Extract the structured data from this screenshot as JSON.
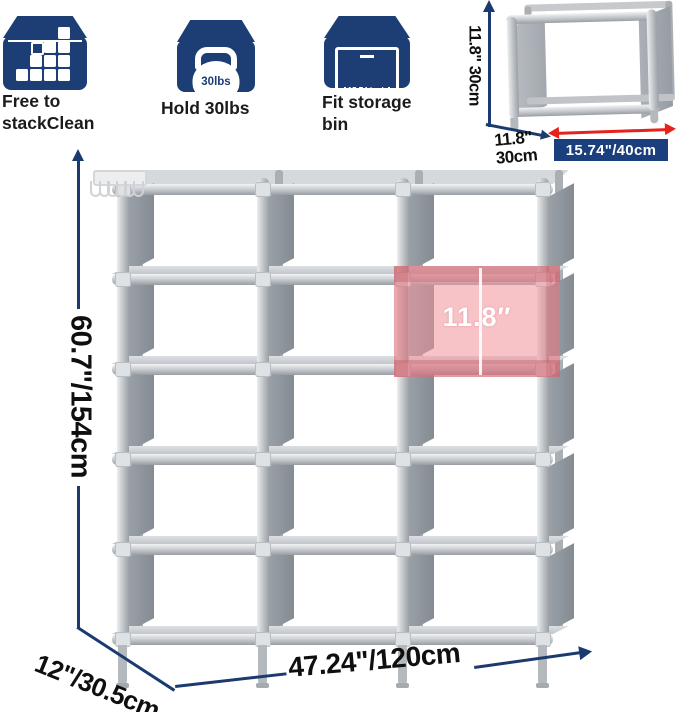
{
  "features": [
    {
      "icon": "stack-cubes-icon",
      "label_line1": "Free to",
      "label_line2": "stackClean"
    },
    {
      "icon": "kettlebell-icon",
      "label_line1": "Hold 30lbs",
      "weight_text": "30lbs"
    },
    {
      "icon": "storage-bin-icon",
      "label_line1": "Fit storage",
      "label_line2": "bin",
      "bin_text": "15.74 inch"
    }
  ],
  "mini_unit": {
    "height_label": "11.8\" 30cm",
    "depth_label_line1": "11.8\"",
    "depth_label_line2": "30cm",
    "width_badge": "15.74\"/40cm"
  },
  "main_unit": {
    "height_label": "60.7\"/154cm",
    "depth_label": "12\"/30.5cm",
    "width_label": "47.24\"/120cm",
    "cell_height_label": "11.8″",
    "hook_count": 6,
    "columns": 3,
    "rows": 5
  },
  "colors": {
    "navy": "#1a3a70",
    "icon_navy": "#1c3e74",
    "red": "#e6231b",
    "pink_highlight": "#f39299",
    "tube_gray": "#c3c7cb",
    "panel_gray": "#8a9198"
  }
}
